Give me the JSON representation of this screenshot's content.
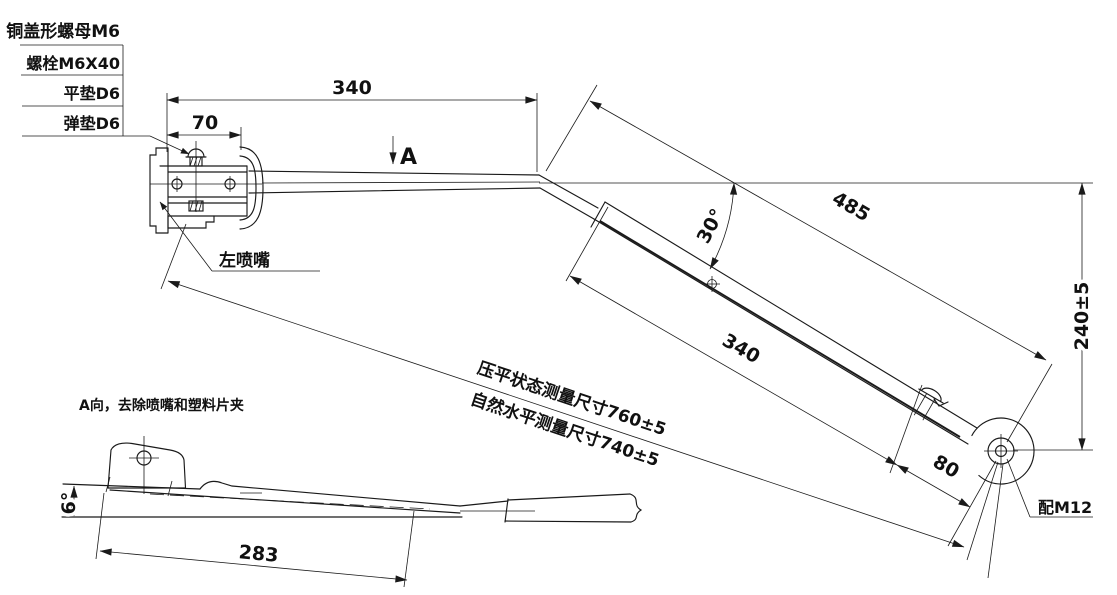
{
  "background": "#ffffff",
  "line_color": "#1a1a1a",
  "parts_list": [
    "铜盖形螺母M6",
    "螺栓M6X40",
    "平垫D6",
    "弹垫D6"
  ],
  "main_view": {
    "dim_arm_to_bend": "340",
    "dim_head_section": "70",
    "section_marker": "A",
    "dim_upper_link": "485",
    "dim_bend_angle": "30°",
    "dim_lower_link": "340",
    "dim_end_section": "80",
    "dim_drop_height": "240±5",
    "note_pressed": "压平状态测量尺寸760±5",
    "note_natural": "自然水平测量尺寸740±5",
    "label_left_nozzle": "左喷嘴",
    "label_fit_m12": "配M12"
  },
  "view_a": {
    "title": "A向，去除喷嘴和塑料片夹",
    "dim_tilt_angle": "6°",
    "dim_blade_length": "283"
  }
}
